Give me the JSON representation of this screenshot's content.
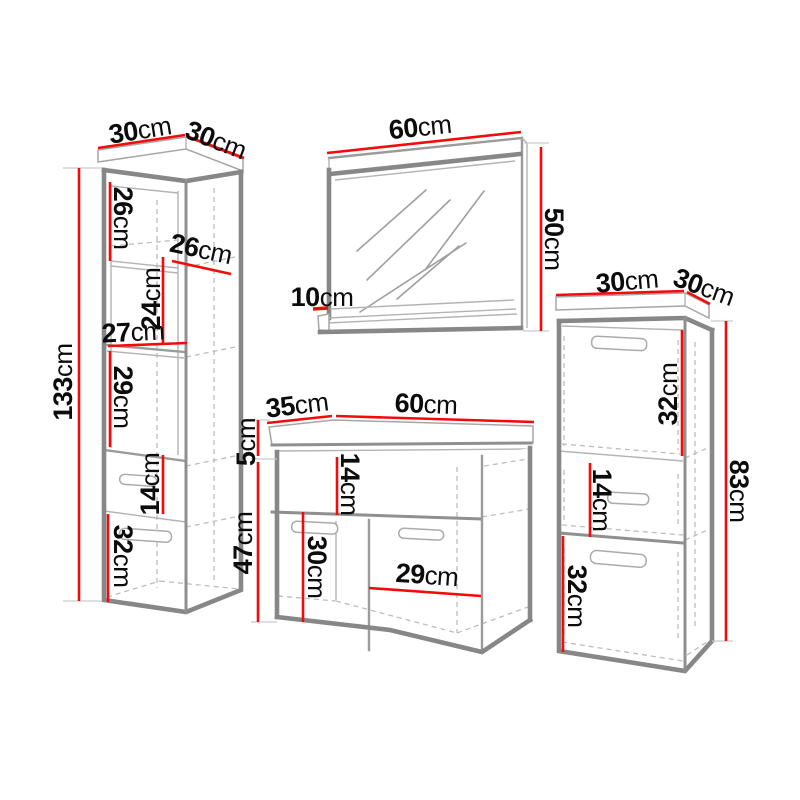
{
  "colors": {
    "dimension_red": "#f50a0a",
    "outline_gray": "#878787",
    "line_gray": "#9b9b9b",
    "dashed_gray": "#bdbdbd",
    "label_black": "#0c0c0c",
    "background": "#ffffff"
  },
  "pieces": {
    "tall_cabinet": {
      "dims": {
        "width": {
          "num": "30",
          "unit": "cm"
        },
        "depth": {
          "num": "30",
          "unit": "cm"
        },
        "height": {
          "num": "133",
          "unit": "cm"
        },
        "niche1": {
          "num": "26",
          "unit": "cm"
        },
        "niche_depth": {
          "num": "26",
          "unit": "cm"
        },
        "niche2": {
          "num": "24",
          "unit": "cm"
        },
        "niche_width": {
          "num": "27",
          "unit": "cm"
        },
        "niche3": {
          "num": "29",
          "unit": "cm"
        },
        "drawer": {
          "num": "14",
          "unit": "cm"
        },
        "door": {
          "num": "32",
          "unit": "cm"
        }
      }
    },
    "mirror": {
      "dims": {
        "width": {
          "num": "60",
          "unit": "cm"
        },
        "height": {
          "num": "50",
          "unit": "cm"
        },
        "shelf_depth": {
          "num": "10",
          "unit": "cm"
        }
      }
    },
    "vanity": {
      "dims": {
        "depth": {
          "num": "35",
          "unit": "cm"
        },
        "width": {
          "num": "60",
          "unit": "cm"
        },
        "countertop": {
          "num": "5",
          "unit": "cm"
        },
        "height": {
          "num": "47",
          "unit": "cm"
        },
        "drawer": {
          "num": "14",
          "unit": "cm"
        },
        "door_height": {
          "num": "30",
          "unit": "cm"
        },
        "door_width": {
          "num": "29",
          "unit": "cm"
        }
      }
    },
    "side_cabinet": {
      "dims": {
        "width": {
          "num": "30",
          "unit": "cm"
        },
        "depth": {
          "num": "30",
          "unit": "cm"
        },
        "height": {
          "num": "83",
          "unit": "cm"
        },
        "top_door": {
          "num": "32",
          "unit": "cm"
        },
        "middle": {
          "num": "14",
          "unit": "cm"
        },
        "bottom_door": {
          "num": "32",
          "unit": "cm"
        }
      }
    }
  }
}
